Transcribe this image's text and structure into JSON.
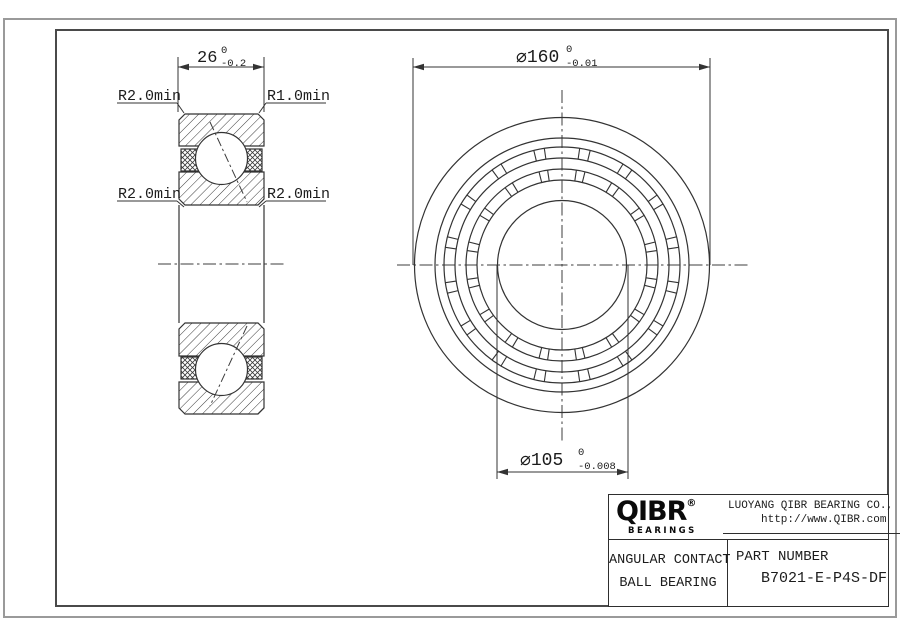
{
  "colors": {
    "line": "#333333",
    "text": "#1c1c1c",
    "frame_outer": "#9a9a9a",
    "frame_inner": "#4a4a4a"
  },
  "section_view": {
    "width_dim_value": "26",
    "width_dim_tol_upper": "0",
    "width_dim_tol_lower": "-0.2",
    "leader_top_left": "R2.0min",
    "leader_top_right": "R1.0min",
    "leader_mid_left": "R2.0min",
    "leader_mid_right": "R2.0min"
  },
  "front_view": {
    "od_dim_value": "⌀160",
    "od_dim_tol_upper": "0",
    "od_dim_tol_lower": "-0.01",
    "bore_dim_value": "⌀105",
    "bore_dim_tol_upper": "0",
    "bore_dim_tol_lower": "-0.008"
  },
  "title_block": {
    "brand": "QIBR",
    "registered_mark": "®",
    "brand_sub": "BEARINGS",
    "company": "LUOYANG QIBR BEARING CO., LTD",
    "website": "http://www.QIBR.com",
    "product_line1": "ANGULAR CONTACT",
    "product_line2": "BALL BEARING",
    "part_number_label": "PART NUMBER",
    "part_number": "B7021-E-P4S-DF"
  }
}
